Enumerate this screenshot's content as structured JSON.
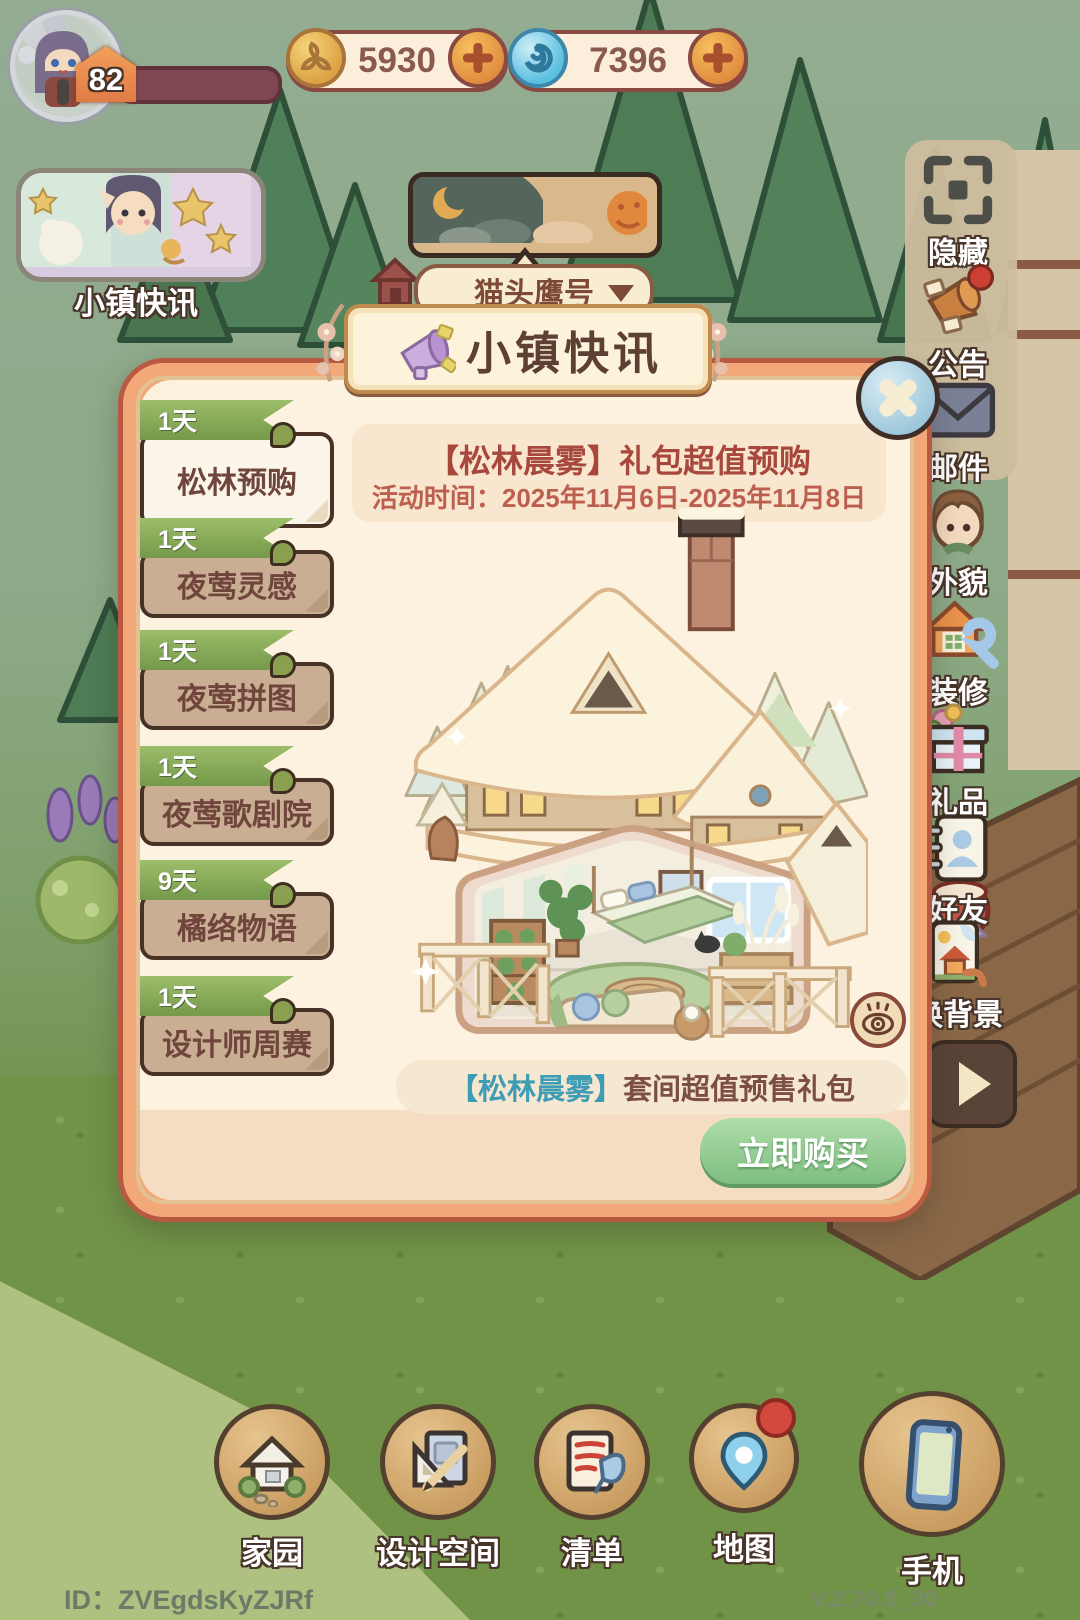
{
  "hud": {
    "level": "82",
    "currencies": [
      {
        "name": "leaf-coin",
        "value": "5930"
      },
      {
        "name": "aqua-orb",
        "value": "7396"
      }
    ],
    "news_shortcut_label": "小镇快讯",
    "ship_selector_label": "猫头鹰号"
  },
  "sidebar": {
    "items": [
      {
        "label": "隐藏",
        "icon": "hide-icon"
      },
      {
        "label": "公告",
        "icon": "announcement-icon"
      },
      {
        "label": "邮件",
        "icon": "mail-icon"
      },
      {
        "label": "外貌",
        "icon": "appearance-icon"
      },
      {
        "label": "装修",
        "icon": "renovate-icon"
      },
      {
        "label": "礼品",
        "icon": "gift-icon"
      },
      {
        "label": "好友",
        "icon": "friends-icon"
      },
      {
        "label": "换背景",
        "icon": "change-background-icon"
      }
    ]
  },
  "dialog": {
    "title": "小镇快讯",
    "events": [
      {
        "days": "1天",
        "label": "松林预购",
        "selected": true
      },
      {
        "days": "1天",
        "label": "夜莺灵感",
        "selected": false
      },
      {
        "days": "1天",
        "label": "夜莺拼图",
        "selected": false
      },
      {
        "days": "1天",
        "label": "夜莺歌剧院",
        "selected": false
      },
      {
        "days": "9天",
        "label": "橘络物语",
        "selected": false
      },
      {
        "days": "1天",
        "label": "设计师周赛",
        "selected": false
      }
    ],
    "content": {
      "title": "【松林晨雾】礼包超值预购",
      "time": "活动时间：2025年11月6日-2025年11月8日",
      "caption_highlight": "【松林晨雾】",
      "caption_rest": "套间超值预售礼包",
      "buy_label": "立即购买"
    }
  },
  "bottom_nav": [
    {
      "label": "家园",
      "icon": "home-icon"
    },
    {
      "label": "设计空间",
      "icon": "design-space-icon"
    },
    {
      "label": "清单",
      "icon": "checklist-icon"
    },
    {
      "label": "地图",
      "icon": "map-icon"
    },
    {
      "label": "手机",
      "icon": "phone-icon"
    }
  ],
  "footer": {
    "player_id": "ID：ZVEgdsKyZJRf",
    "version": "V.2.70.0_30"
  },
  "colors": {
    "accent_green": "#7ca34f",
    "buy_green": "#8cc98b",
    "title_brown": "#5d4033",
    "header_red": "#a8473c",
    "caption_teal": "#3e9cb5",
    "frame_orange": "#e0845c"
  }
}
